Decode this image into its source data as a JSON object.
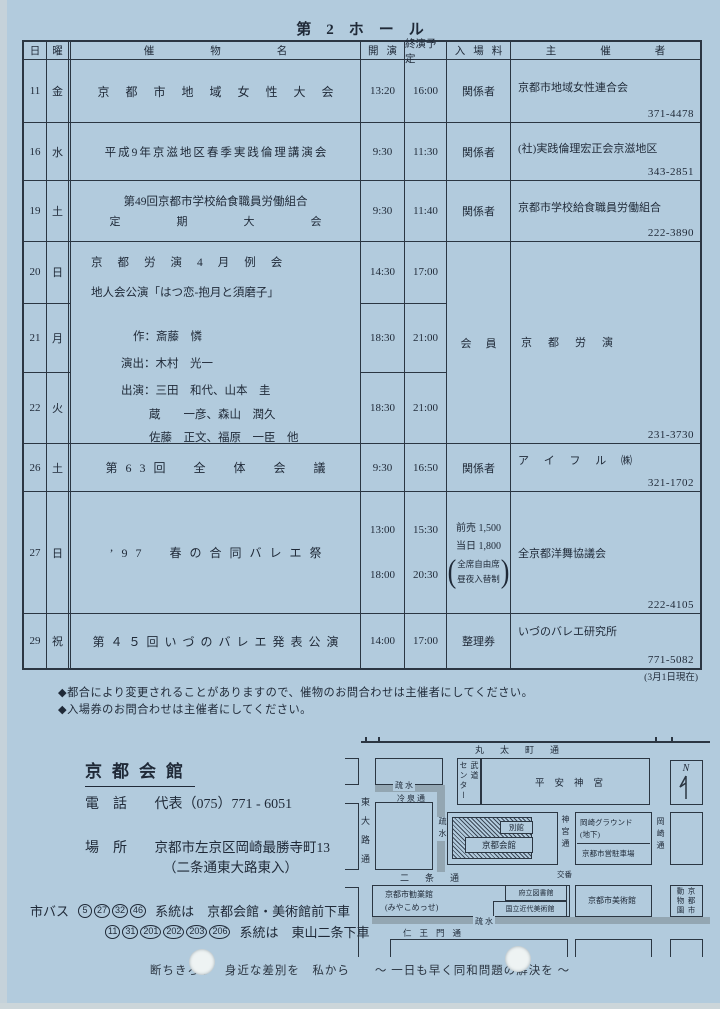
{
  "page": {
    "title": "第　2　ホ　ー　ル",
    "as_of": "(3月1日現在)",
    "notes": [
      "◆都合により変更されることがありますので、催物のお問合わせは主催者にしてください。",
      "◆入場券のお問合わせは主催者にしてください。"
    ],
    "slogan": "断ちきろう　身近な差別を　私から　　～ 一日も早く同和問題の解決を ～"
  },
  "table": {
    "headers": {
      "day": "日",
      "weekday": "曜",
      "event": "催物名",
      "start": "開演",
      "end": "終演予定",
      "fee": "入場料",
      "organizer": "主催者"
    },
    "rows": [
      {
        "day": "11",
        "wd": "金",
        "title": "京都市地域女性大会",
        "start": "13:20",
        "end": "16:00",
        "fee": "関係者",
        "org": "京都市地域女性連合会",
        "tel": "371-4478"
      },
      {
        "day": "16",
        "wd": "水",
        "title": "平成9年京滋地区春季実践倫理講演会",
        "start": "9:30",
        "end": "11:30",
        "fee": "関係者",
        "org": "(社)実践倫理宏正会京滋地区",
        "tel": "343-2851"
      },
      {
        "day": "19",
        "wd": "土",
        "title1": "第49回京都市学校給食職員労働組合",
        "title2": "定期大会",
        "start": "9:30",
        "end": "11:40",
        "fee": "関係者",
        "org": "京都市学校給食職員労働組合",
        "tel": "222-3890"
      },
      {
        "days": [
          {
            "day": "20",
            "wd": "日",
            "start": "14:30",
            "end": "17:00"
          },
          {
            "day": "21",
            "wd": "月",
            "start": "18:30",
            "end": "21:00"
          },
          {
            "day": "22",
            "wd": "火",
            "start": "18:30",
            "end": "21:00"
          }
        ],
        "lines": [
          "京都労演4月例会",
          "地人会公演「はつ恋-抱月と須磨子」",
          "作：斎藤　憐",
          "演出：木村　光一",
          "出演：三田　和代、山本　圭",
          "蔵　　一彦、森山　潤久",
          "佐藤　正文、福原　一臣　他"
        ],
        "fee": "会員",
        "org": "京都労演",
        "tel": "231-3730"
      },
      {
        "day": "26",
        "wd": "土",
        "title": "第63回　全　体　会　議",
        "start": "9:30",
        "end": "16:50",
        "fee": "関係者",
        "org": "ア イ フ ル ㈱",
        "tel": "321-1702"
      },
      {
        "day": "27",
        "wd": "日",
        "title": "’97　春の合同バレエ祭",
        "times": [
          {
            "start": "13:00",
            "end": "15:30"
          },
          {
            "start": "18:00",
            "end": "20:30"
          }
        ],
        "fee_line1": "前売 1,500",
        "fee_line2": "当日 1,800",
        "fee_paren1": "全席自由席",
        "fee_paren2": "昼夜入替制",
        "org": "全京都洋舞協議会",
        "tel": "222-4105"
      },
      {
        "day": "29",
        "wd": "祝",
        "title": "第４５回いづのバレエ発表公演",
        "start": "14:00",
        "end": "17:00",
        "fee": "整理券",
        "org": "いづのバレエ研究所",
        "tel": "771-5082"
      }
    ]
  },
  "venue": {
    "name": "京都会館",
    "phone_label": "電　話",
    "phone": "代表（075）771 - 6051",
    "place_label": "場　所",
    "address1": "京都市左京区岡崎最勝寺町13",
    "address2": "（二条通東大路東入）"
  },
  "bus": {
    "label": "市バス",
    "row1": {
      "numbers": [
        "5",
        "27",
        "32",
        "46"
      ],
      "text": "系統は　京都会館・美術館前下車"
    },
    "row2": {
      "numbers": [
        "11",
        "31",
        "201",
        "202",
        "203",
        "206"
      ],
      "text": "系統は　東山二条下車"
    }
  },
  "map": {
    "labels": {
      "marutamachi": "丸太町通",
      "budo1": "武道",
      "budo2": "センター",
      "heian": "平安神宮",
      "north": "N",
      "higashioji": "東大路通",
      "sosui_top": "疏 水",
      "reisen": "冷 泉 通",
      "sosui_side": "疏水",
      "bekkan": "別館",
      "kaikan": "京都会館",
      "jingudori": "神宮通",
      "ground": "岡崎グラウンド",
      "chika": "(地下)",
      "parking": "京都市営駐車場",
      "okazakidori": "岡崎通",
      "nijo": "二条通",
      "koban": "交番",
      "kangyokan": "京都市勧業館",
      "miyako": "(みやこめっせ)",
      "library": "府立図書館",
      "momak": "国立近代美術館",
      "citymuseum": "京都市美術館",
      "zoo1": "京都市",
      "zoo2": "動物園",
      "sosui_bottom": "疏 水",
      "niomon": "仁王門通"
    }
  }
}
